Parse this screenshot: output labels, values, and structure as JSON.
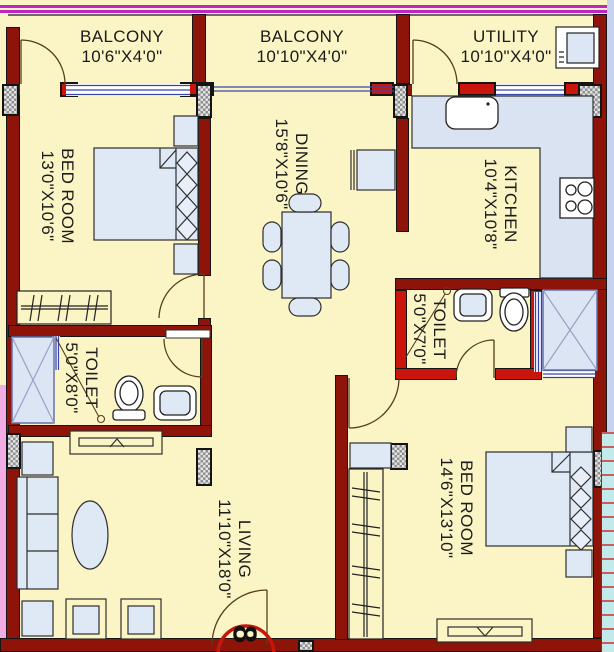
{
  "unit_badge": "8",
  "rooms": {
    "balcony1": {
      "name": "BALCONY",
      "dims": "10'6\"X4'0\""
    },
    "balcony2": {
      "name": "BALCONY",
      "dims": "10'10\"X4'0\""
    },
    "utility": {
      "name": "UTILITY",
      "dims": "10'10\"X4'0\""
    },
    "bedroom1": {
      "name": "BED ROOM",
      "dims": "13'0\"X10'6\""
    },
    "dining": {
      "name": "DINING",
      "dims": "15'8\"X10'6\""
    },
    "kitchen": {
      "name": "KITCHEN",
      "dims": "10'4\"X10'8\""
    },
    "toilet1": {
      "name": "TOILET",
      "dims": "5'0\"X8'0\""
    },
    "toilet2": {
      "name": "TOILET",
      "dims": "5'0\"X7'0\""
    },
    "living": {
      "name": "LIVING",
      "dims": "11'10\"X18'0\""
    },
    "bedroom2": {
      "name": "BED ROOM",
      "dims": "14'6\"X13'10\""
    }
  },
  "colors": {
    "floor": "#FBF4C5",
    "outer_wall": "#8E1309",
    "inner_wall_red": "#C9150C",
    "furniture_fill": "#DFE8F5",
    "window_blue": "#3845A8",
    "boundary_magenta": "#C522C5",
    "exterior_pink": "#F2AEE4",
    "exterior_blue": "#C7D3EE",
    "stair_teal": "#C3EAEA",
    "badge_ring_red": "#C3170D"
  },
  "icons": [
    "bed-icon",
    "pillow-icon",
    "wardrobe-hanger-icon",
    "dining-table-icon",
    "chair-icon",
    "sofa-icon",
    "coffee-table-icon",
    "tv-unit-icon",
    "dresser-icon",
    "kitchen-counter-icon",
    "sink-icon",
    "stove-icon",
    "washing-machine-icon",
    "toilet-wc-icon",
    "wash-basin-icon",
    "door-swing-icon",
    "window-icon",
    "shaft-x-icon",
    "column-icon"
  ]
}
